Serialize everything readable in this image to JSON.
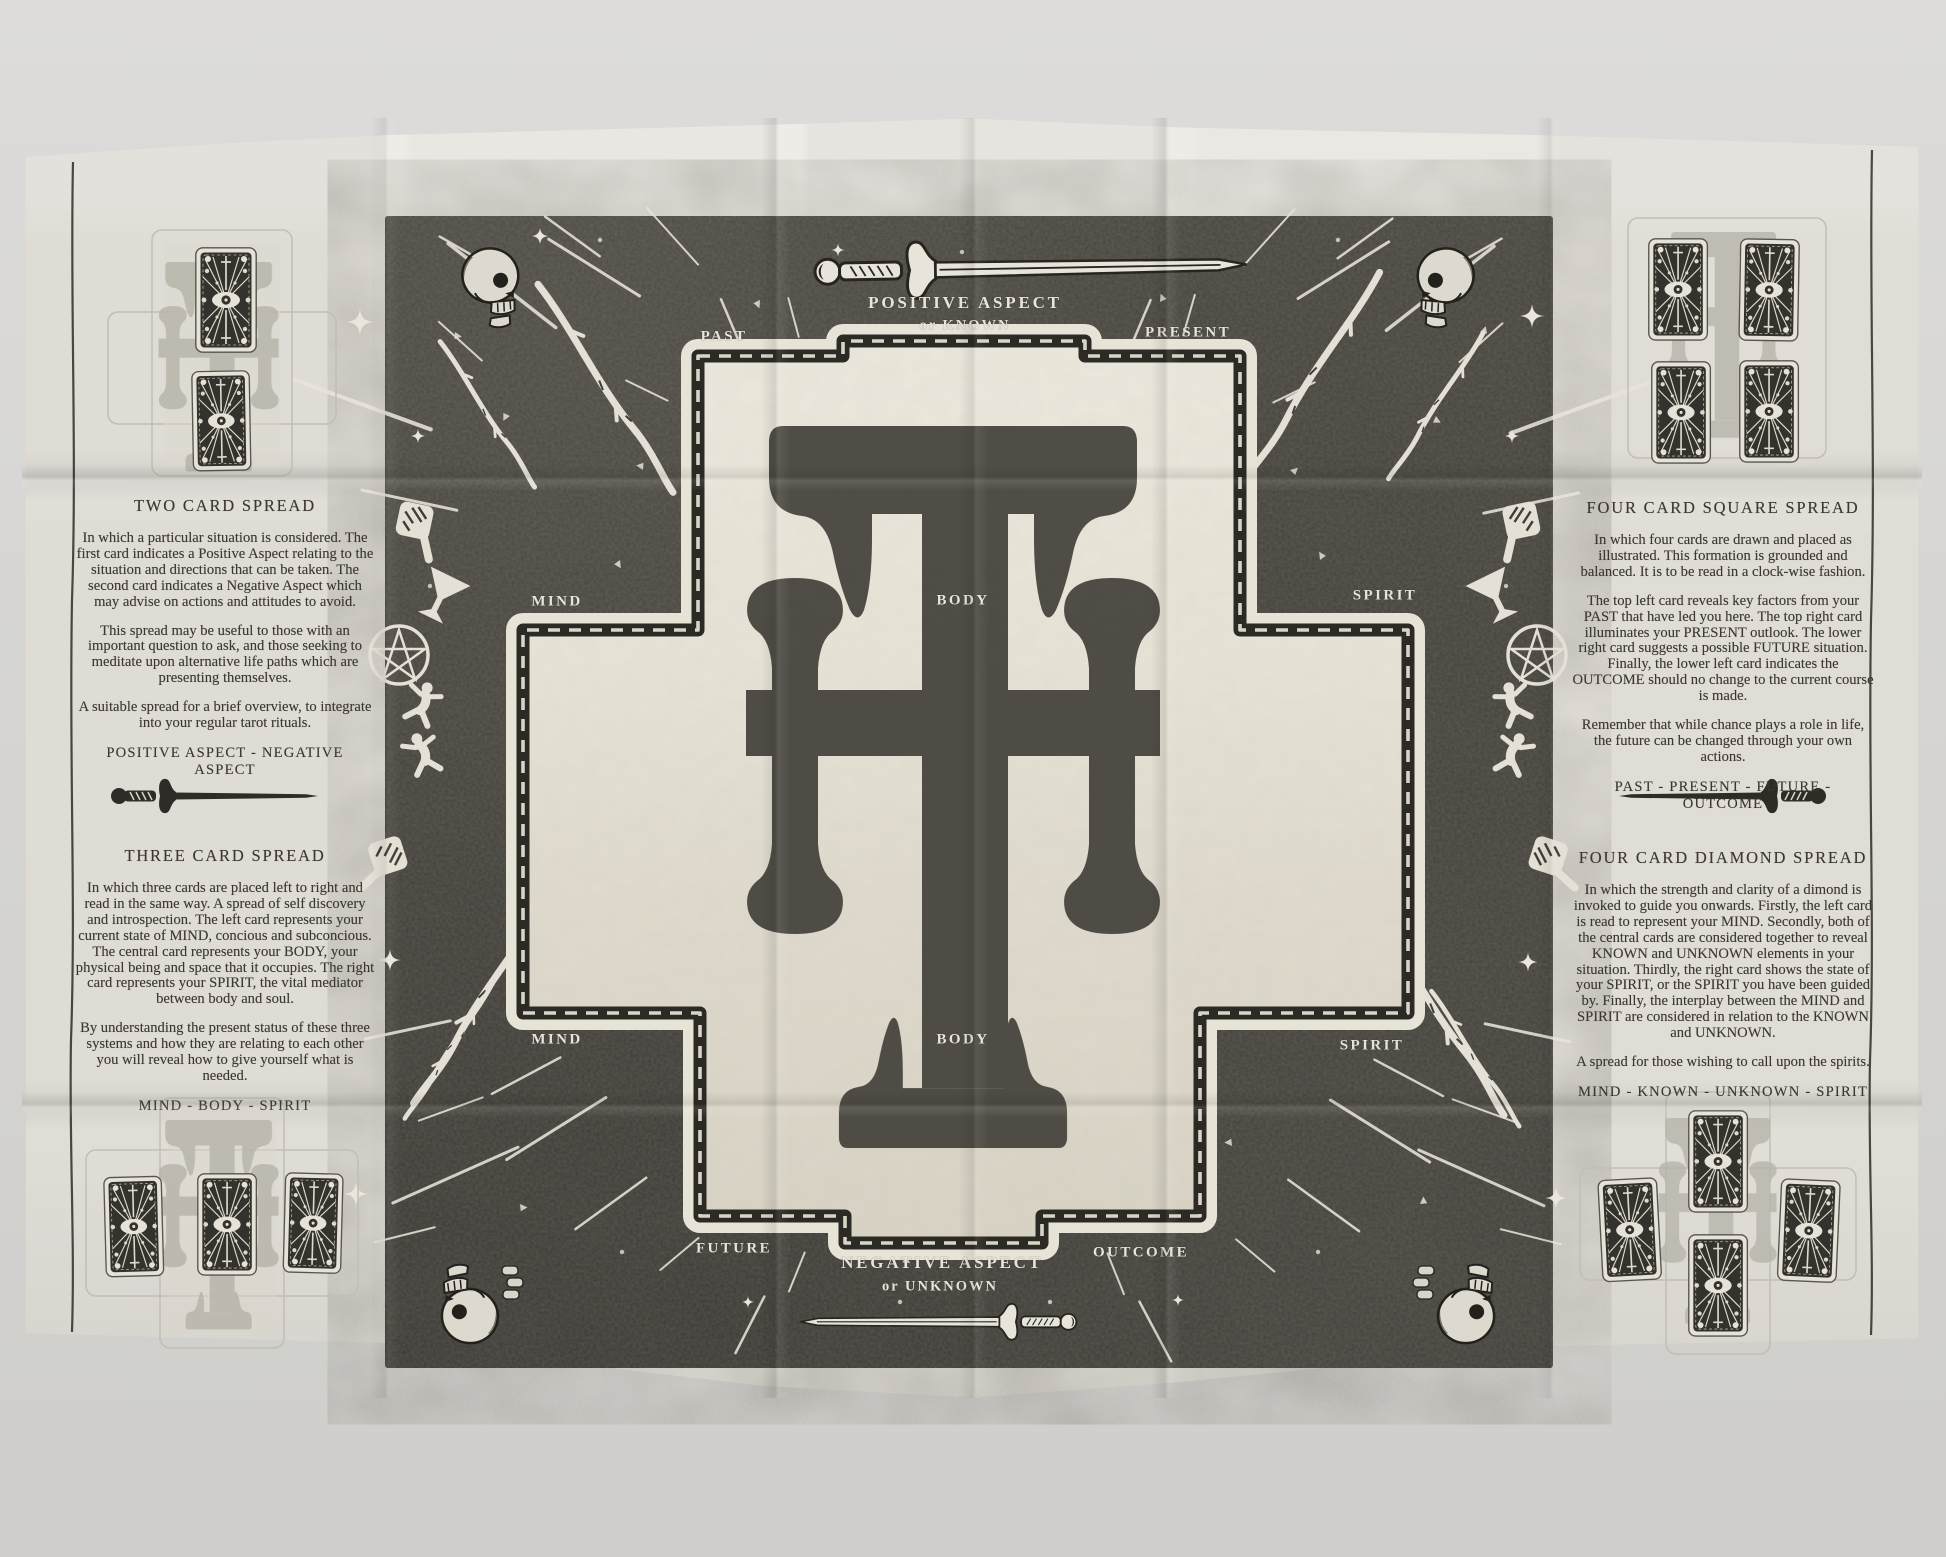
{
  "panels": {
    "left": {
      "two_card": {
        "title": "TWO CARD SPREAD",
        "p1": "In which a particular situation is considered. The first card indicates a Positive Aspect relating to the situation and directions that can be taken. The second card indicates a Negative Aspect which may advise on actions and attitudes to avoid.",
        "p2": "This spread may be useful to those with an important question to ask, and those seeking to meditate upon alternative life paths which are presenting themselves.",
        "p3": "A suitable spread for a brief overview, to integrate into your regular tarot rituals.",
        "keywords": "POSITIVE ASPECT  -  NEGATIVE ASPECT"
      },
      "three_card": {
        "title": "THREE CARD SPREAD",
        "p1": "In which three cards are placed left to right and read in the same way. A spread of self discovery and introspection. The left card represents your current state of MIND, concious and subconcious. The central card represents your BODY, your physical being and space that it occupies. The right card represents your SPIRIT, the vital mediator between body and soul.",
        "p2": "By understanding the present status of these three systems and how they are relating to each other you will reveal how to give yourself what is needed.",
        "keywords": "MIND  -  BODY  -  SPIRIT"
      }
    },
    "right": {
      "square": {
        "title": "FOUR CARD SQUARE SPREAD",
        "p1": "In which four cards are drawn and placed as illustrated. This formation is grounded and balanced. It is to be read in a clock-wise fashion.",
        "p2": "The top left card reveals key factors from your PAST that have led you here. The top right card illuminates your PRESENT outlook. The lower right card suggests a possible FUTURE situation. Finally, the lower left card indicates the OUTCOME should no change to the current course is made.",
        "p3": "Remember that while chance plays a role in life, the future can be changed through your own actions.",
        "keywords": "PAST  -  PRESENT  -  FUTURE  -  OUTCOME"
      },
      "diamond": {
        "title": "FOUR CARD DIAMOND SPREAD",
        "p1": "In which the strength and clarity of a dimond is invoked to guide you onwards. Firstly, the left card is read to represent your MIND. Secondly, both of the central cards are considered together to reveal KNOWN and UNKNOWN elements in your situation. Thirdly, the right card shows the state of your SPIRIT, or the SPIRIT you have been guided by. Finally, the interplay between the MIND and SPIRIT are considered in relation to the KNOWN and UNKNOWN.",
        "p2": "A spread for those wishing to call upon the spirits.",
        "keywords": "MIND  -  KNOWN  -  UNKNOWN  -  SPIRIT"
      }
    }
  },
  "board": {
    "top_line1": "POSITIVE ASPECT",
    "top_line2": "or KNOWN",
    "bottom_line1": "NEGATIVE ASPECT",
    "bottom_line2": "or UNKNOWN",
    "past": "PAST",
    "present": "PRESENT",
    "future": "FUTURE",
    "outcome": "OUTCOME",
    "mind": "MIND",
    "body": "BODY",
    "spirit": "SPIRIT"
  },
  "icons": {
    "card_back": "card-back-icon",
    "eye": "eye-icon",
    "skull": "skull-icon",
    "sword": "sword-icon",
    "goblet": "goblet-icon",
    "pentacle": "pentacle-icon",
    "wand": "wand-icon",
    "falling_figure": "falling-figure-icon",
    "paddle": "paddle-icon",
    "sparkle": "sparkle-icon",
    "monogram": "th-monogram"
  },
  "colors": {
    "paper": "#e9e6df",
    "panel_dark": "#403e38",
    "cross_cream": "#e7e3d7",
    "ink": "#3b382f",
    "label_white": "#e7e3d8"
  }
}
